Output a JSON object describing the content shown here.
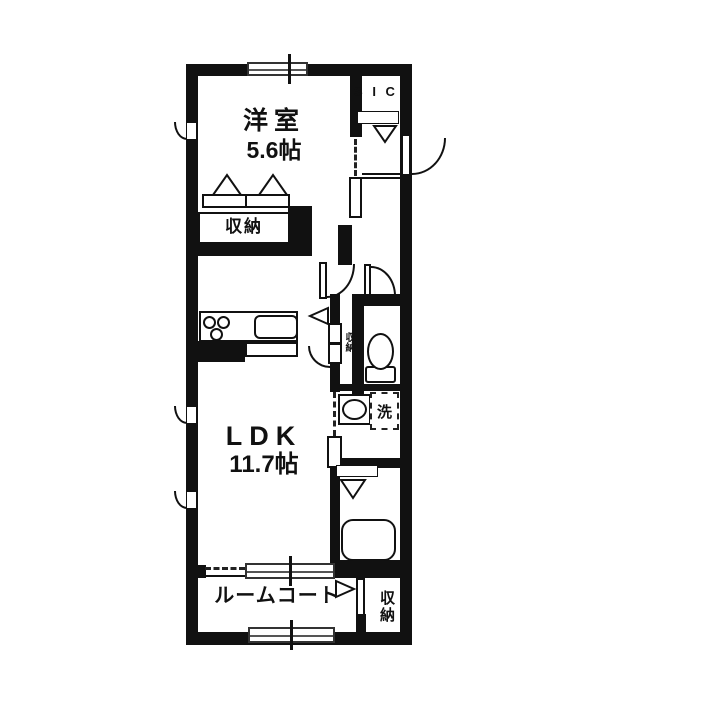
{
  "title": "1LDK floor plan",
  "rooms": {
    "western_room": {
      "name": "洋室",
      "size": "5.6帖"
    },
    "ldk": {
      "name": "LDK",
      "size": "11.7帖"
    },
    "sic": {
      "name": "S I C"
    },
    "western_closet": {
      "name": "収納"
    },
    "hall_closet": {
      "name": "収納"
    },
    "laundry": {
      "name": "洗"
    },
    "room_court": {
      "name": "ルームコート"
    },
    "court_closet": {
      "name": "収納"
    }
  },
  "colors": {
    "wall": "#111111",
    "background": "#ffffff",
    "window_line": "#333333"
  }
}
